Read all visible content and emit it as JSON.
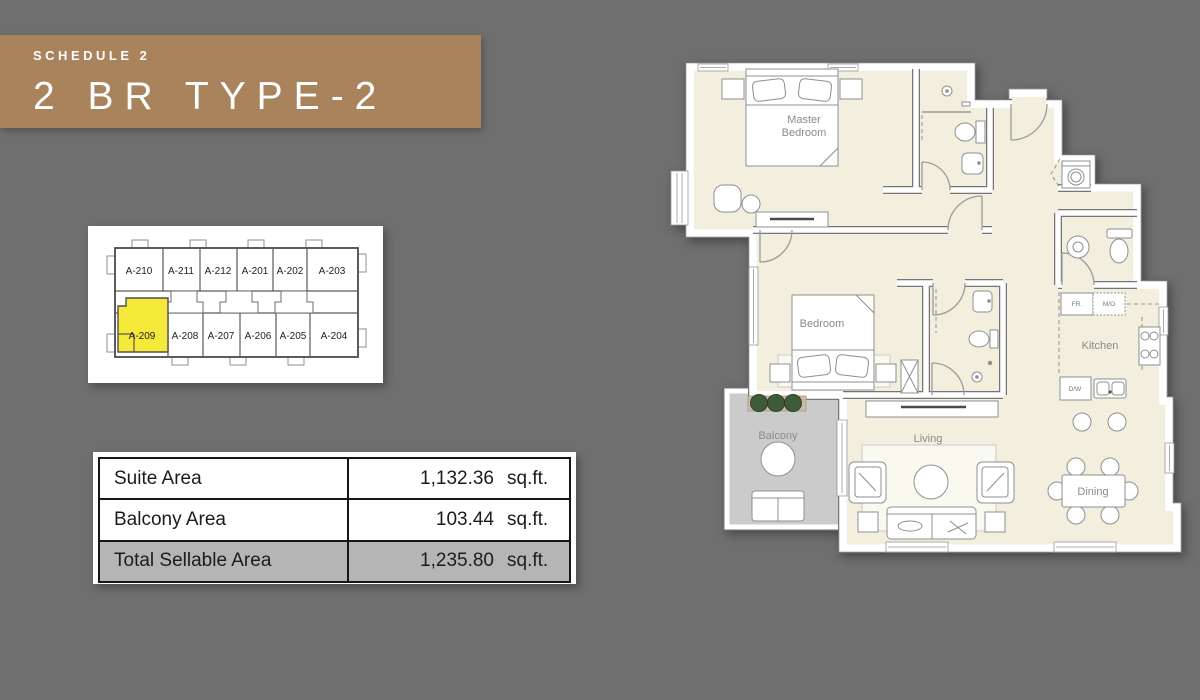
{
  "page": {
    "background": "#6f6f6f"
  },
  "banner": {
    "schedule_label": "SCHEDULE 2",
    "title": "2 BR TYPE-2",
    "background": "#a8835c"
  },
  "key_plan": {
    "highlighted_unit": "A-209",
    "highlight_color": "#f5e93a",
    "top_row_units": [
      "A-210",
      "A-211",
      "A-212",
      "A-201",
      "A-202",
      "A-203"
    ],
    "bottom_row_units": [
      "A-209",
      "A-208",
      "A-207",
      "A-206",
      "A-205",
      "A-204"
    ]
  },
  "area_table": {
    "rows": [
      {
        "label": "Suite Area",
        "value": "1,132.36",
        "unit": "sq.ft."
      },
      {
        "label": "Balcony Area",
        "value": "103.44",
        "unit": "sq.ft."
      },
      {
        "label": "Total Sellable Area",
        "value": "1,235.80",
        "unit": "sq.ft."
      }
    ],
    "total_row_background": "#b5b5b5"
  },
  "floor_plan": {
    "labels": {
      "master_bedroom_line1": "Master",
      "master_bedroom_line2": "Bedroom",
      "bedroom": "Bedroom",
      "kitchen": "Kitchen",
      "living": "Living",
      "dining": "Dining",
      "balcony": "Balcony",
      "fridge": "FR.",
      "microwave": "M/O",
      "dishwasher": "D/W"
    },
    "colors": {
      "floor": "#f2efde",
      "cabinet": "#cdbbaa",
      "balcony_floor": "#cbcbcb",
      "wall_edge": "#757575",
      "label_text": "#8a8a8a",
      "plant": "#3f5b38"
    }
  }
}
